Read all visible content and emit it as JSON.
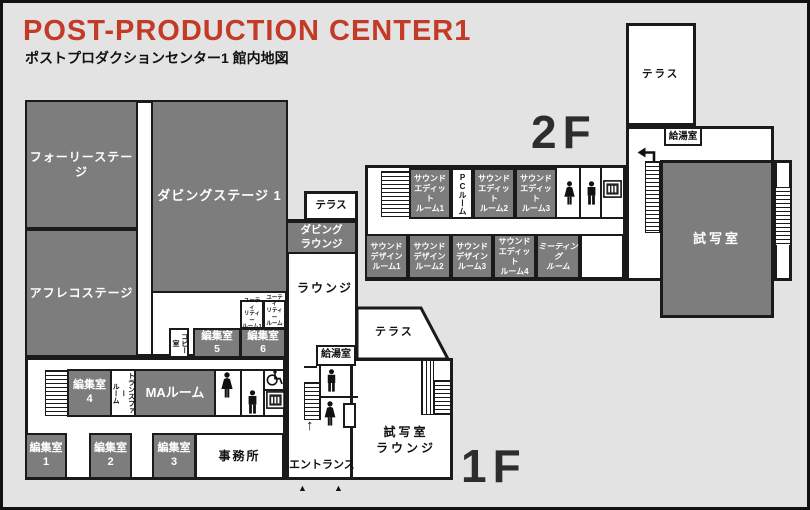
{
  "header": {
    "title": "POST-PRODUCTION CENTER1",
    "subtitle": "ポストプロダクションセンター1 館内地図"
  },
  "floor_labels": {
    "second": "2F",
    "first": "1F"
  },
  "f1": {
    "foley": "フォーリーステージ",
    "dubbing_stage": "ダビングステージ 1",
    "afreco": "アフレコステージ",
    "terrace_small": "テラス",
    "dubbing_lounge": "ダビング\nラウンジ",
    "lounge": "ラウンジ",
    "utility1": "ユーティ\nリティー\nルーム1",
    "utility2": "ユーティ\nリティー\nルーム2",
    "copy_room": "コピー室",
    "edit5": "編集室\n5",
    "edit6": "編集室\n6",
    "edit4": "編集室\n4",
    "transfer": "トランスファー\nルーム",
    "ma_room": "MAルーム",
    "edit1": "編集室\n1",
    "edit2": "編集室\n2",
    "edit3": "編集室\n3",
    "office": "事務所",
    "kyuto": "給湯室",
    "terrace_big": "テラス",
    "shisha_lounge": "試写室\nラウンジ",
    "entrance": "エントランス",
    "up_arrow": "↑",
    "triangle": "▲"
  },
  "f2": {
    "terrace": "テラス",
    "kyuto": "給湯室",
    "se1": "サウンド\nエディット\nルーム1",
    "pc_room": "PCルーム",
    "se2": "サウンド\nエディット\nルーム2",
    "se3": "サウンド\nエディット\nルーム3",
    "sd1": "サウンド\nデザイン\nルーム1",
    "sd2": "サウンド\nデザイン\nルーム2",
    "sd3": "サウンド\nデザイン\nルーム3",
    "se4": "サウンド\nエディット\nルーム4",
    "meeting": "ミーティング\nルーム",
    "screening": "試写室"
  },
  "colors": {
    "room_gray": "#7d7d7d",
    "background": "#e3e3e3",
    "wall": "#1a1a1a",
    "title_red": "#c33b27"
  }
}
